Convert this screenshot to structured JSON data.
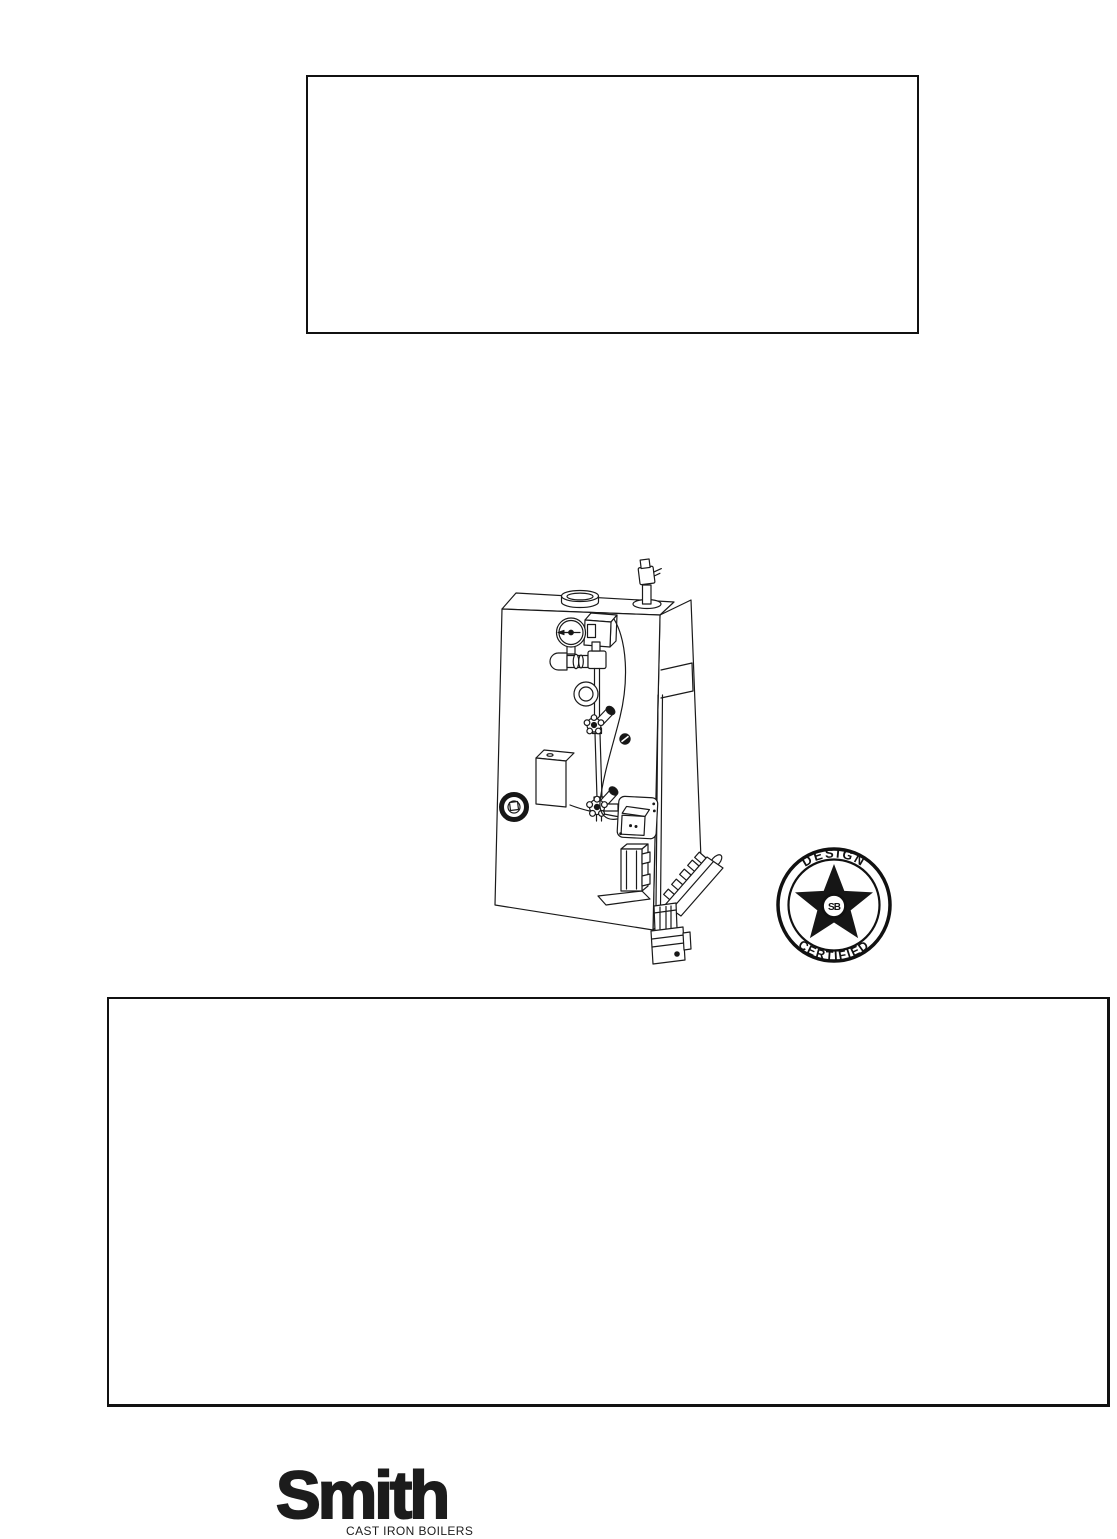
{
  "page": {
    "background": "#ffffff",
    "ink": "#111111"
  },
  "seal": {
    "name": "design-certified-seal",
    "arc_top": "DESIGN",
    "arc_bottom": "CERTIFIED",
    "monogram": "SB"
  },
  "logo": {
    "brand": "Smith",
    "tagline": "CAST IRON BOILERS"
  },
  "illustration": {
    "name": "gas-steam-boiler-line-drawing"
  }
}
